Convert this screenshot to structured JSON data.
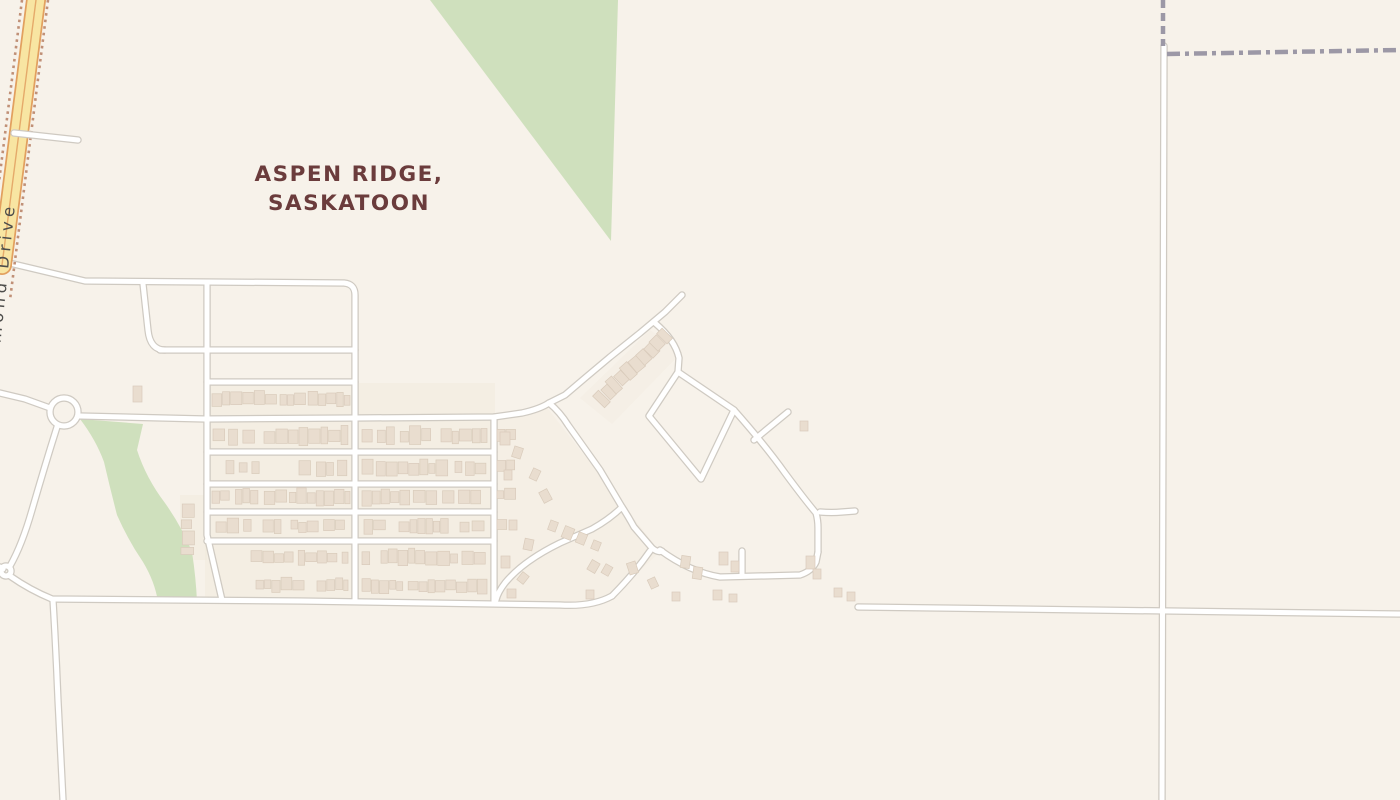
{
  "map": {
    "title": {
      "line1": "ASPEN RIDGE,",
      "line2": "SASKATOON",
      "color": "#6b3c3c",
      "x": 349,
      "y1": 181,
      "y2": 210,
      "size": 21.5
    },
    "road_label": {
      "text": "McOrmond Drive",
      "color": "#4d4d4b",
      "size": 16.5,
      "x": -6,
      "y": 404,
      "rotation": -84
    },
    "colors": {
      "background": "#f7f2ea",
      "green": "#cfe0bd",
      "tint": "#f1e8da",
      "road_fill": "#ffffff",
      "road_casing": "#cfcac2",
      "major_fill": "#f8e5a2",
      "major_casing": "#e2a05f",
      "major_centerline": "#e5aa6a",
      "construction_dots": "#c09077",
      "boundary": "#9c98a6",
      "building_fill": "#e9ddcf",
      "building_stroke": "#d9cbbb"
    },
    "green_areas": [
      {
        "name": "park-triangle",
        "d": "M430,0 L618,0 L611,241 Z"
      },
      {
        "name": "greenway-strip",
        "d": "M80,419 L143,424 L137,450 Q146,478 165,503 Q182,527 192,552 Q196,578 197,602 L158,602 Q155,582 143,562 Q128,540 117,515 Q110,488 104,462 Q96,440 80,419 Z"
      }
    ],
    "tint_areas": [
      {
        "d": "M205,383 L495,383 L495,601 L205,601 Z",
        "opacity": 0.4
      },
      {
        "d": "M494,418 L545,405 L660,552 L612,596 L560,605 L494,601 Z",
        "opacity": 0.3
      },
      {
        "d": "M180,495 L207,495 L207,560 L180,560 Z",
        "opacity": 0.4
      },
      {
        "d": "M580,398 L650,330 L682,352 L612,424 Z",
        "opacity": 0.28
      }
    ],
    "minor_roads": [
      {
        "name": "top-road",
        "d": "M5,262 L85,281 L344,283 Q355,284 355,295 L355,601"
      },
      {
        "name": "vertical-street-west",
        "d": "M207,283 L207,535 L222,600"
      },
      {
        "name": "connector-street",
        "d": "M143,284 L148,330 Q150,350 165,350"
      },
      {
        "name": "cross-street-350",
        "d": "M160,350 L355,350"
      },
      {
        "name": "cross-street-382",
        "d": "M207,382 L355,382"
      },
      {
        "name": "collector-417",
        "d": "M80,416 L205,419 L355,418 L494,417 L522,413 Q540,409 549,403"
      },
      {
        "name": "cross-street-452",
        "d": "M207,452 L494,452"
      },
      {
        "name": "cross-street-484",
        "d": "M207,484 L494,484"
      },
      {
        "name": "cross-street-512",
        "d": "M207,512 L494,512"
      },
      {
        "name": "cross-street-541",
        "d": "M207,541 L494,541"
      },
      {
        "name": "vertical-street-mid",
        "d": "M494,417 L494,601"
      },
      {
        "name": "main-diagonal",
        "d": "M682,295 L665,312 L640,333 L610,357 L585,378 L565,395 L549,403"
      },
      {
        "name": "diagonal-se",
        "d": "M549,403 Q560,412 568,425 L600,470 L622,507 Q628,516 634,527 L652,548 Q658,553 662,551"
      },
      {
        "name": "fork-branch-sw",
        "d": "M650,551 Q634,574 612,596"
      },
      {
        "name": "fork-branch-east",
        "d": "M660,550 Q690,572 720,577 L800,575 Q812,571 816,562 L818,552"
      },
      {
        "name": "loop-connector-ne",
        "d": "M655,323 Q675,340 679,358 L678,372"
      },
      {
        "name": "short-diagonal-ne",
        "d": "M754,440 L788,412"
      },
      {
        "name": "east-curve",
        "d": "M734,410 Q765,445 785,473 Q805,500 816,513 Q818,520 818,528 L818,552"
      },
      {
        "name": "east-spur",
        "d": "M820,512 Q832,513 842,512 L855,511"
      },
      {
        "name": "cul-de-sac-stub",
        "d": "M742,575 L742,551"
      },
      {
        "name": "curve-branch-west",
        "d": "M622,507 Q610,519 592,529 L560,543 Q523,561 505,583 Q498,592 496,600"
      },
      {
        "name": "bottom-road-west",
        "d": "M10,576 Q30,590 52,599 L300,601 L560,605 Q592,607 612,596"
      },
      {
        "name": "bottom-vertical",
        "d": "M53,600 Q56,650 58,700 L63,800"
      },
      {
        "name": "roundabout-west-arm",
        "d": "M0,393 L25,399 L50,408"
      },
      {
        "name": "roundabout-south-arm",
        "d": "M57,427 Q45,465 32,510 Q22,545 10,566"
      },
      {
        "name": "small-roundabout-west-arm",
        "d": "M0,567 L3,569"
      },
      {
        "name": "east-road",
        "d": "M858,607 L1400,614"
      },
      {
        "name": "north-south-road-east",
        "d": "M1164,46 L1162,800"
      }
    ],
    "loop_road": {
      "name": "diamond-loop",
      "d": "M649,416 L678,372 L734,410 L701,479 Z"
    },
    "major_road": {
      "name": "mcormond-drive",
      "d": "M36,0 L2,265",
      "casing_width": 20,
      "fill_width": 16.5,
      "centerline_width": 1.4
    },
    "over_major_roads": [
      {
        "name": "stub-road-east",
        "d": "M14,133 L78,140"
      }
    ],
    "construction_lines": [
      {
        "name": "dots-right",
        "d": "M48,0 L10,300"
      },
      {
        "name": "dots-left",
        "d": "M22,0 L-16,300"
      }
    ],
    "boundary_lines": [
      {
        "name": "boundary-vertical",
        "d": "M1163,0 L1163,46",
        "dash": "8,5"
      },
      {
        "name": "boundary-horizontal",
        "d": "M1167,54 L1400,50",
        "dash": "13,5,4,5"
      }
    ],
    "roundabouts": [
      {
        "name": "roundabout-main",
        "cx": 64,
        "cy": 412,
        "r": 14
      },
      {
        "name": "roundabout-small",
        "cx": 6,
        "cy": 571,
        "r": 5
      }
    ],
    "buildings": {
      "rows": [
        [
          212,
          350,
          399,
          13,
          []
        ],
        [
          213,
          350,
          436,
          15,
          [
            [
              252,
              264
            ]
          ]
        ],
        [
          362,
          487,
          436,
          15,
          [
            [
              430,
              441
            ]
          ]
        ],
        [
          497,
          520,
          435,
          12,
          []
        ],
        [
          226,
          347,
          468,
          12,
          [
            [
              254,
              299
            ]
          ]
        ],
        [
          362,
          487,
          468,
          13,
          [
            [
              444,
              455
            ]
          ]
        ],
        [
          497,
          518,
          466,
          11,
          []
        ],
        [
          212,
          350,
          497,
          12,
          []
        ],
        [
          362,
          487,
          497,
          12,
          []
        ],
        [
          497,
          516,
          495,
          10,
          []
        ],
        [
          216,
          346,
          526,
          12,
          [
            [
              250,
              263
            ],
            [
              280,
              291
            ]
          ]
        ],
        [
          364,
          485,
          526,
          12,
          [
            [
              383,
              399
            ],
            [
              450,
              460
            ]
          ]
        ],
        [
          497,
          514,
          524,
          10,
          []
        ],
        [
          251,
          348,
          557,
          12,
          []
        ],
        [
          362,
          487,
          557,
          12,
          [
            [
              370,
              381
            ]
          ]
        ],
        [
          256,
          348,
          585,
          11,
          [
            [
              301,
              317
            ]
          ]
        ],
        [
          362,
          487,
          586,
          12,
          []
        ]
      ],
      "column": {
        "x": 187,
        "y1": 504,
        "y2": 556,
        "w": 12
      },
      "diagonal_row": {
        "x1": 600,
        "y1": 399,
        "x2": 666,
        "y2": 336,
        "n": 10,
        "w": 9,
        "h": 13,
        "angle": -43
      },
      "scattered": [
        [
          500,
          432,
          10,
          13,
          0
        ],
        [
          513,
          447,
          9,
          11,
          18
        ],
        [
          504,
          470,
          8,
          10,
          0
        ],
        [
          531,
          469,
          8,
          11,
          25
        ],
        [
          541,
          490,
          9,
          12,
          -28
        ],
        [
          549,
          521,
          8,
          10,
          20
        ],
        [
          509,
          520,
          8,
          10,
          0
        ],
        [
          524,
          539,
          9,
          11,
          12
        ],
        [
          501,
          556,
          9,
          12,
          0
        ],
        [
          519,
          573,
          8,
          10,
          38
        ],
        [
          507,
          589,
          9,
          9,
          0
        ],
        [
          563,
          527,
          10,
          12,
          22
        ],
        [
          577,
          533,
          9,
          11,
          22
        ],
        [
          592,
          541,
          8,
          9,
          22
        ],
        [
          589,
          561,
          9,
          11,
          30
        ],
        [
          603,
          565,
          8,
          10,
          30
        ],
        [
          628,
          562,
          9,
          12,
          -18
        ],
        [
          586,
          590,
          8,
          9,
          0
        ],
        [
          649,
          578,
          8,
          10,
          -25
        ],
        [
          681,
          556,
          9,
          12,
          8
        ],
        [
          693,
          567,
          9,
          12,
          8
        ],
        [
          719,
          552,
          9,
          13,
          0
        ],
        [
          731,
          561,
          8,
          11,
          0
        ],
        [
          806,
          556,
          9,
          13,
          0
        ],
        [
          813,
          569,
          8,
          10,
          0
        ],
        [
          834,
          588,
          8,
          9,
          0
        ],
        [
          847,
          592,
          8,
          9,
          0
        ],
        [
          800,
          421,
          8,
          10,
          0
        ],
        [
          713,
          590,
          9,
          10,
          0
        ],
        [
          729,
          594,
          8,
          8,
          0
        ],
        [
          672,
          592,
          8,
          9,
          0
        ],
        [
          133,
          386,
          9,
          16,
          0
        ]
      ]
    },
    "road_widths": {
      "minor_casing": 7.5,
      "minor_fill": 5
    }
  }
}
